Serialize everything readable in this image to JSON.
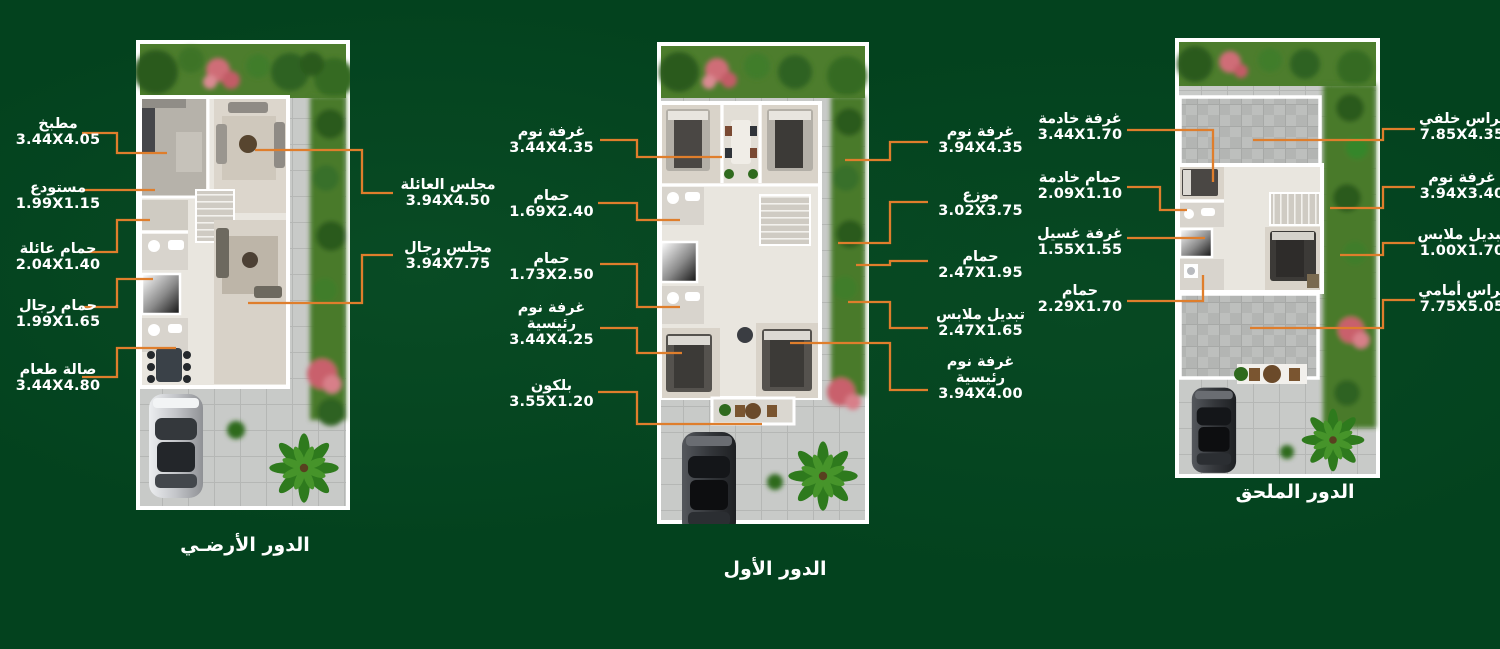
{
  "page": {
    "background_color": "#03421e",
    "connector_color": "#df7e2c",
    "text_color": "#ffffff"
  },
  "plans": [
    {
      "title": "الدور الأرضـي",
      "left_labels": [
        {
          "name": "مطبخ",
          "dims": "3.44X4.05"
        },
        {
          "name": "مستودع",
          "dims": "1.99X1.15"
        },
        {
          "name": "حمام عائلة",
          "dims": "2.04X1.40"
        },
        {
          "name": "حمام رجال",
          "dims": "1.99X1.65"
        },
        {
          "name": "صالة طعام",
          "dims": "3.44X4.80"
        }
      ],
      "right_labels": [
        {
          "name": "مجلس العائلة",
          "dims": "3.94X4.50"
        },
        {
          "name": "مجلس رجال",
          "dims": "3.94X7.75"
        }
      ]
    },
    {
      "title": "الدور الأول",
      "left_labels": [
        {
          "name": "غرفة نوم",
          "dims": "3.44X4.35"
        },
        {
          "name": "حمام",
          "dims": "1.69X2.40"
        },
        {
          "name": "حمام",
          "dims": "1.73X2.50"
        },
        {
          "name": "غرفة نوم رئيسية",
          "dims": "3.44X4.25"
        },
        {
          "name": "بلكون",
          "dims": "3.55X1.20"
        }
      ],
      "right_labels": [
        {
          "name": "غرفة نوم",
          "dims": "3.94X4.35"
        },
        {
          "name": "موزع",
          "dims": "3.02X3.75"
        },
        {
          "name": "حمام",
          "dims": "2.47X1.95"
        },
        {
          "name": "تبديل ملابس",
          "dims": "2.47X1.65"
        },
        {
          "name": "غرفة نوم رئيسية",
          "dims": "3.94X4.00"
        }
      ]
    },
    {
      "title": "الدور الملحق",
      "left_labels": [
        {
          "name": "غرفة خادمة",
          "dims": "3.44X1.70"
        },
        {
          "name": "حمام خادمة",
          "dims": "2.09X1.10"
        },
        {
          "name": "غرفة غسيل",
          "dims": "1.55X1.55"
        },
        {
          "name": "حمام",
          "dims": "2.29X1.70"
        }
      ],
      "right_labels": [
        {
          "name": "تراس خلفي",
          "dims": "7.85X4.35"
        },
        {
          "name": "غرفة نوم",
          "dims": "3.94X3.40"
        },
        {
          "name": "تبديل ملابس",
          "dims": "1.00X1.70"
        },
        {
          "name": "تراس أمامي",
          "dims": "7.75X5.05"
        }
      ]
    }
  ]
}
